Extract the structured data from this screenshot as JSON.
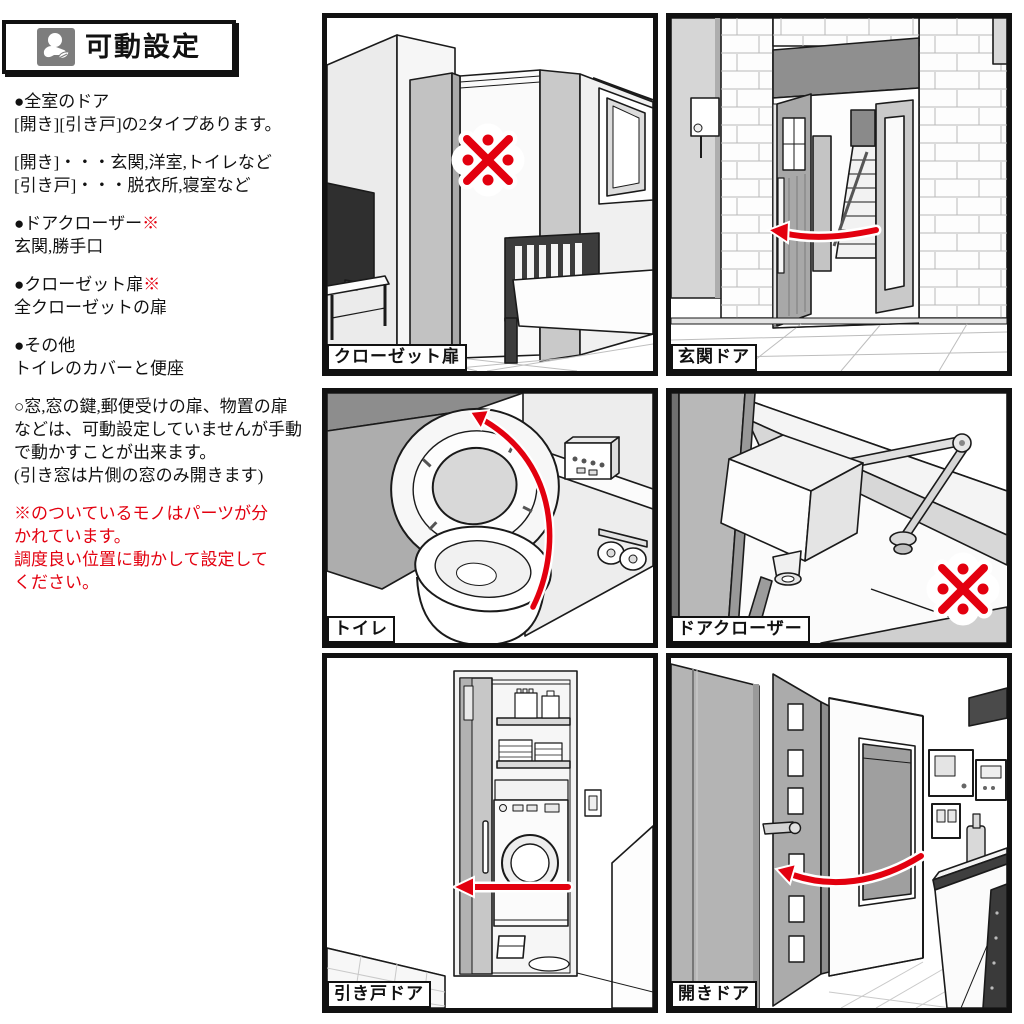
{
  "header": {
    "title": "可動設定",
    "icon": "hand-with-sprout"
  },
  "sidebar": {
    "paragraphs": [
      {
        "lines": [
          "●全室のドア",
          "[開き][引き戸]の2タイプあります。"
        ]
      },
      {
        "lines": [
          "[開き]・・・玄関,洋室,トイレなど",
          "[引き戸]・・・脱衣所,寝室など"
        ]
      },
      {
        "title": "●ドアクローザー",
        "mark": "※",
        "lines": [
          "玄関,勝手口"
        ]
      },
      {
        "title": "●クローゼット扉",
        "mark": "※",
        "lines": [
          "全クローゼットの扉"
        ]
      },
      {
        "lines": [
          "●その他",
          "トイレのカバーと便座"
        ]
      },
      {
        "lines": [
          "○窓,窓の鍵,郵便受けの扉、物置の扉",
          "などは、可動設定していませんが手動",
          "で動かすことが出来ます。",
          "(引き窓は片側の窓のみ開きます)"
        ]
      },
      {
        "red": true,
        "lines": [
          "※のついているモノはパーツが分",
          "かれています。",
          "調度良い位置に動かして設定して",
          "ください。"
        ]
      }
    ]
  },
  "panels": [
    {
      "label": "クローゼット扉",
      "annotation": "※"
    },
    {
      "label": "玄関ドア",
      "annotation": "arrow-open-left"
    },
    {
      "label": "トイレ",
      "annotation": "arrow-lid-up"
    },
    {
      "label": "ドアクローザー",
      "annotation": "※"
    },
    {
      "label": "引き戸ドア",
      "annotation": "arrow-slide-left"
    },
    {
      "label": "開きドア",
      "annotation": "arrow-open-left"
    }
  ],
  "colors": {
    "accent_red": "#e3000f",
    "frame_black": "#111111",
    "icon_grey": "#7d7d7d"
  }
}
